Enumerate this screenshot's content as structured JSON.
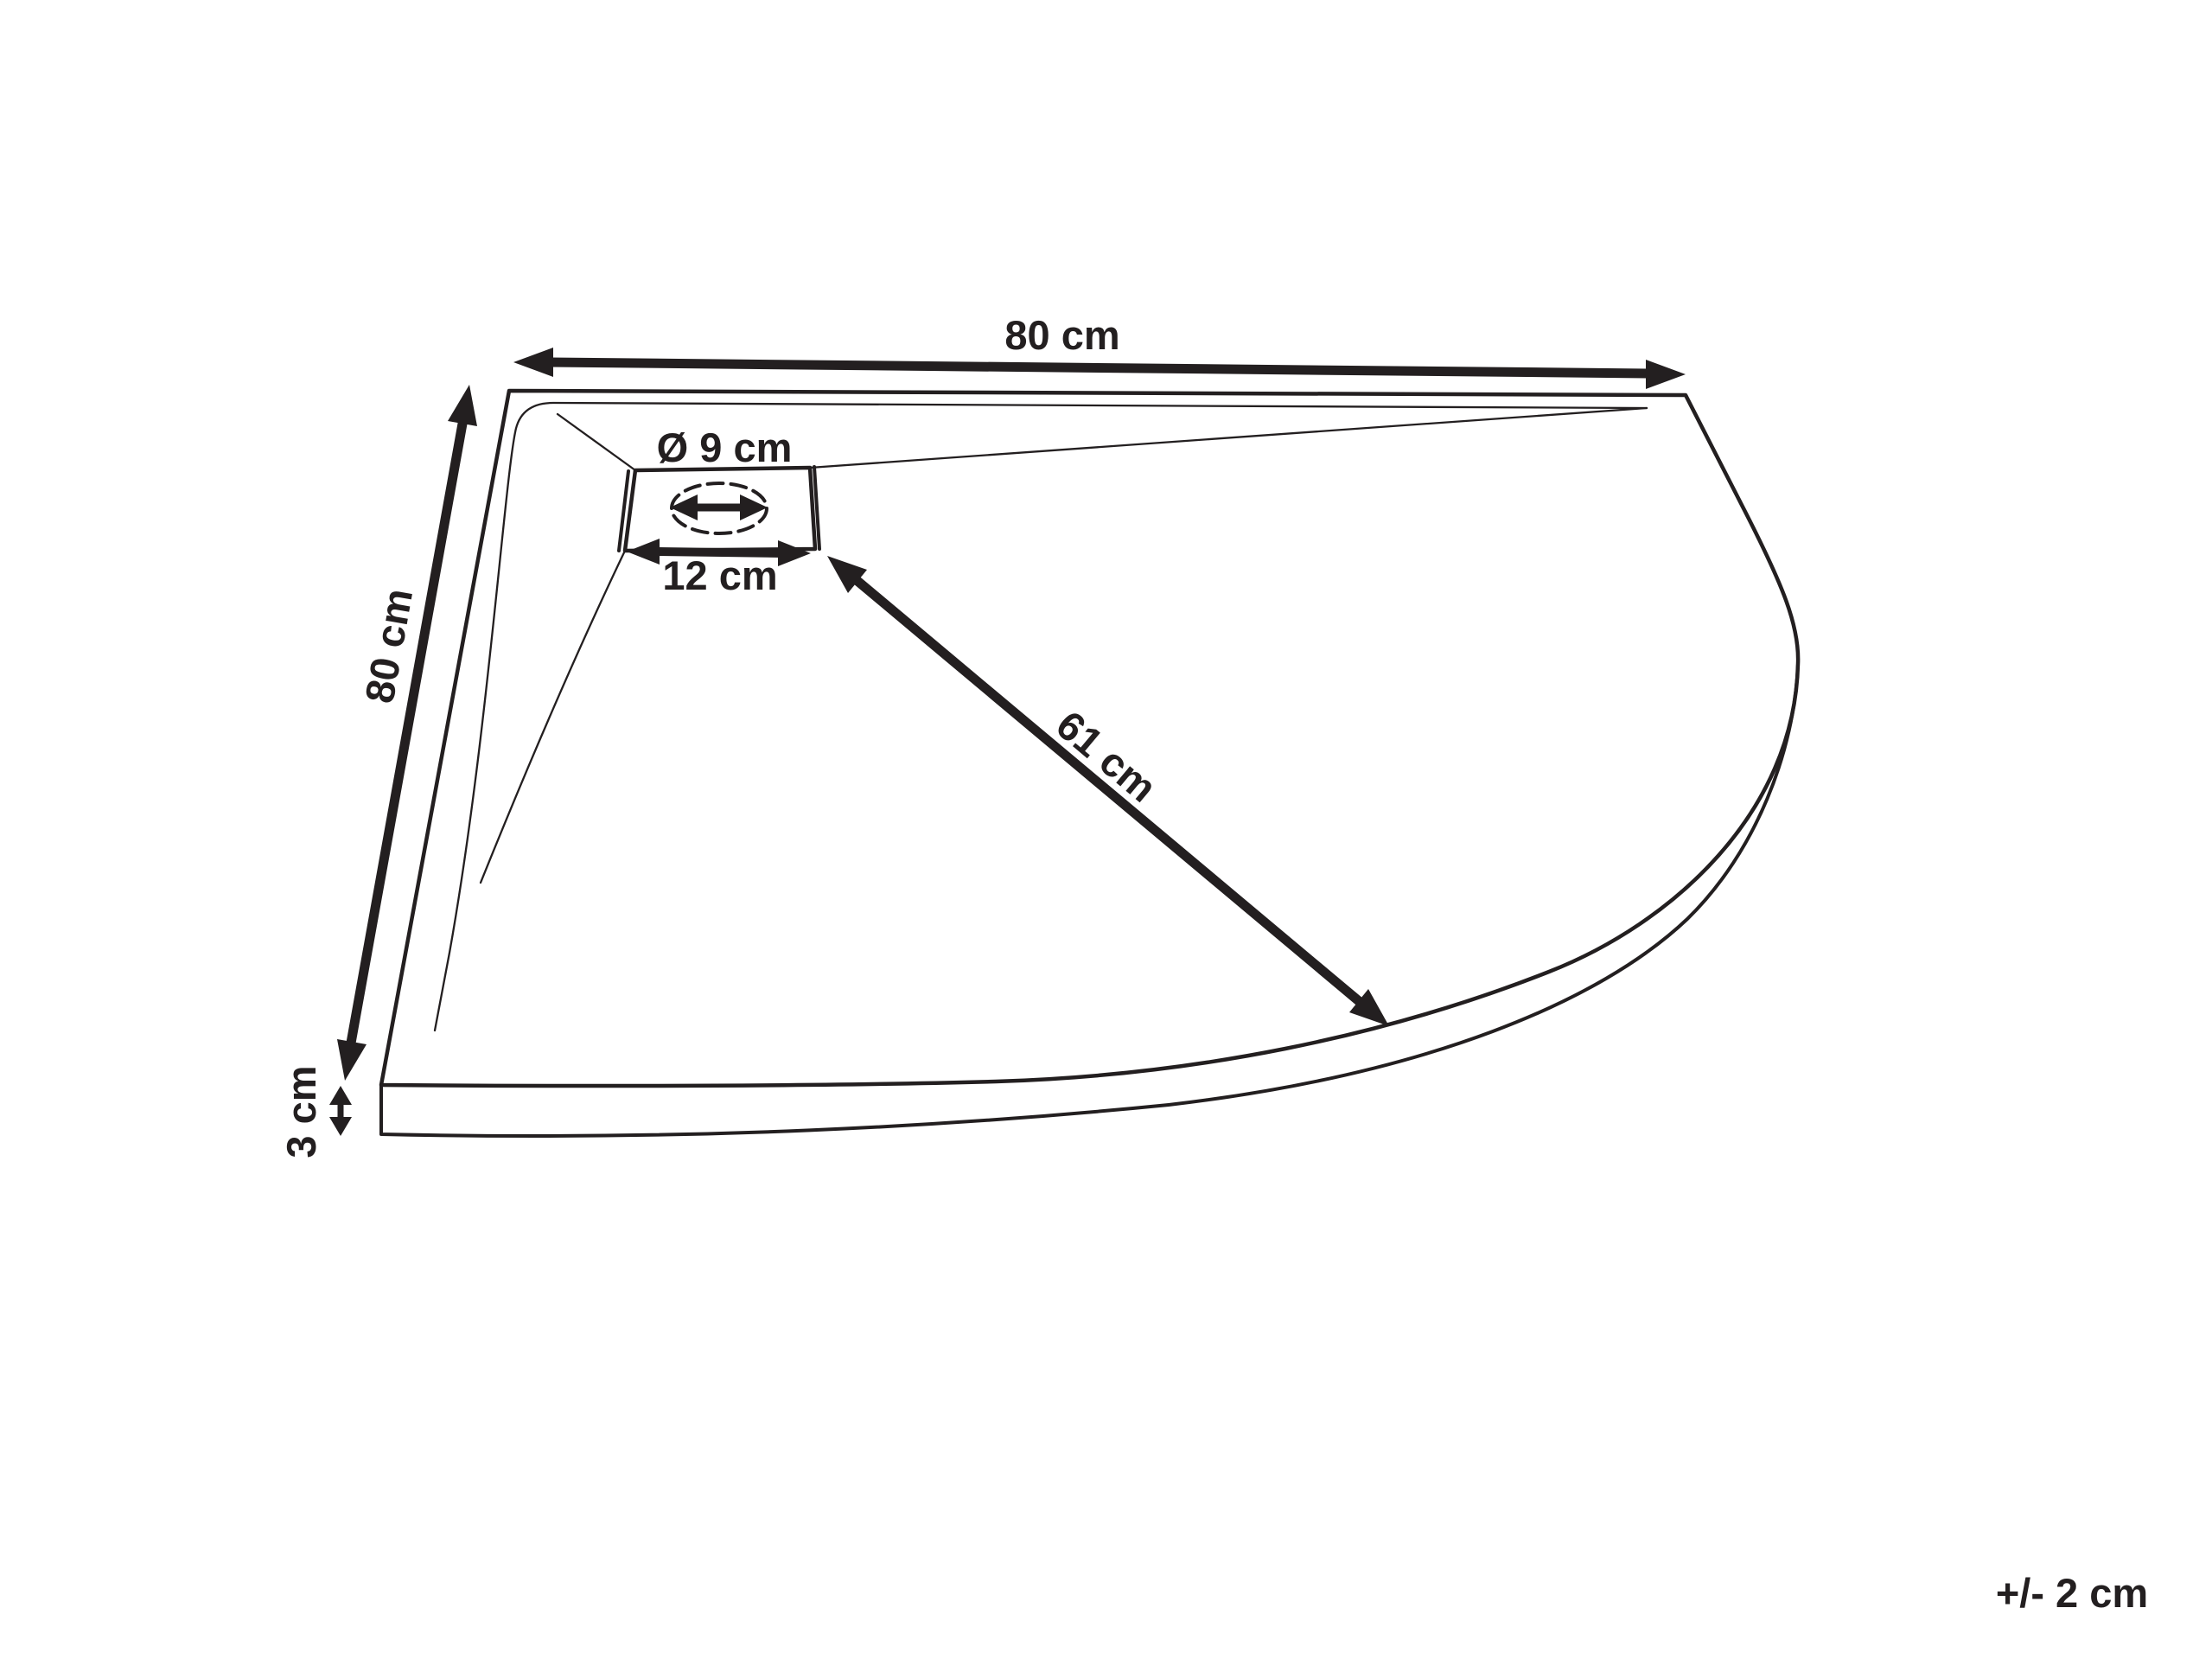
{
  "colors": {
    "ink": "#231f20",
    "background": "#ffffff"
  },
  "dimensions": {
    "top_width_label": "80 cm",
    "left_depth_label": "80 cm",
    "drain_diameter_label": "Ø 9 cm",
    "drain_width_label": "12 cm",
    "drain_diagonal_label": "61 cm",
    "thickness_label": "3 cm",
    "tolerance_note": "+/- 2 cm"
  }
}
